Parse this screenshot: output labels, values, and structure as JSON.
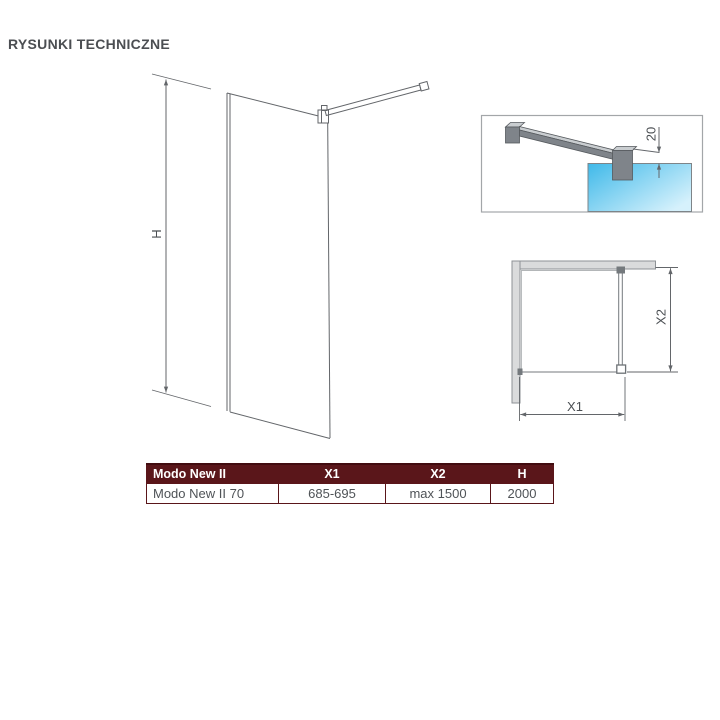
{
  "page": {
    "title": "RYSUNKI TECHNICZNE"
  },
  "drawings": {
    "front_view": {
      "height_label": "H"
    },
    "detail_view": {
      "dimension_label": "20"
    },
    "top_view": {
      "width_label": "X1",
      "depth_label": "X2"
    }
  },
  "table": {
    "columns": [
      "Modo New II",
      "X1",
      "X2",
      "H"
    ],
    "rows": [
      [
        "Modo New II 70",
        "685-695",
        "max 1500",
        "2000"
      ]
    ]
  },
  "colors": {
    "title_color": "#4b4e52",
    "line": "#63666a",
    "dim_text": "#4b4f53",
    "wall_fill": "#dadbdc",
    "wall_stroke": "#8e9296",
    "metal": "#7f848a",
    "metal_light": "#c9cdd0",
    "metal_dark": "#565a5e",
    "glass_blue_start": "#3fb9e9",
    "glass_blue_end": "#d6f1fc",
    "table_header_bg": "#5a161a",
    "table_border": "#5a161a",
    "table_text": "#4f5357"
  }
}
